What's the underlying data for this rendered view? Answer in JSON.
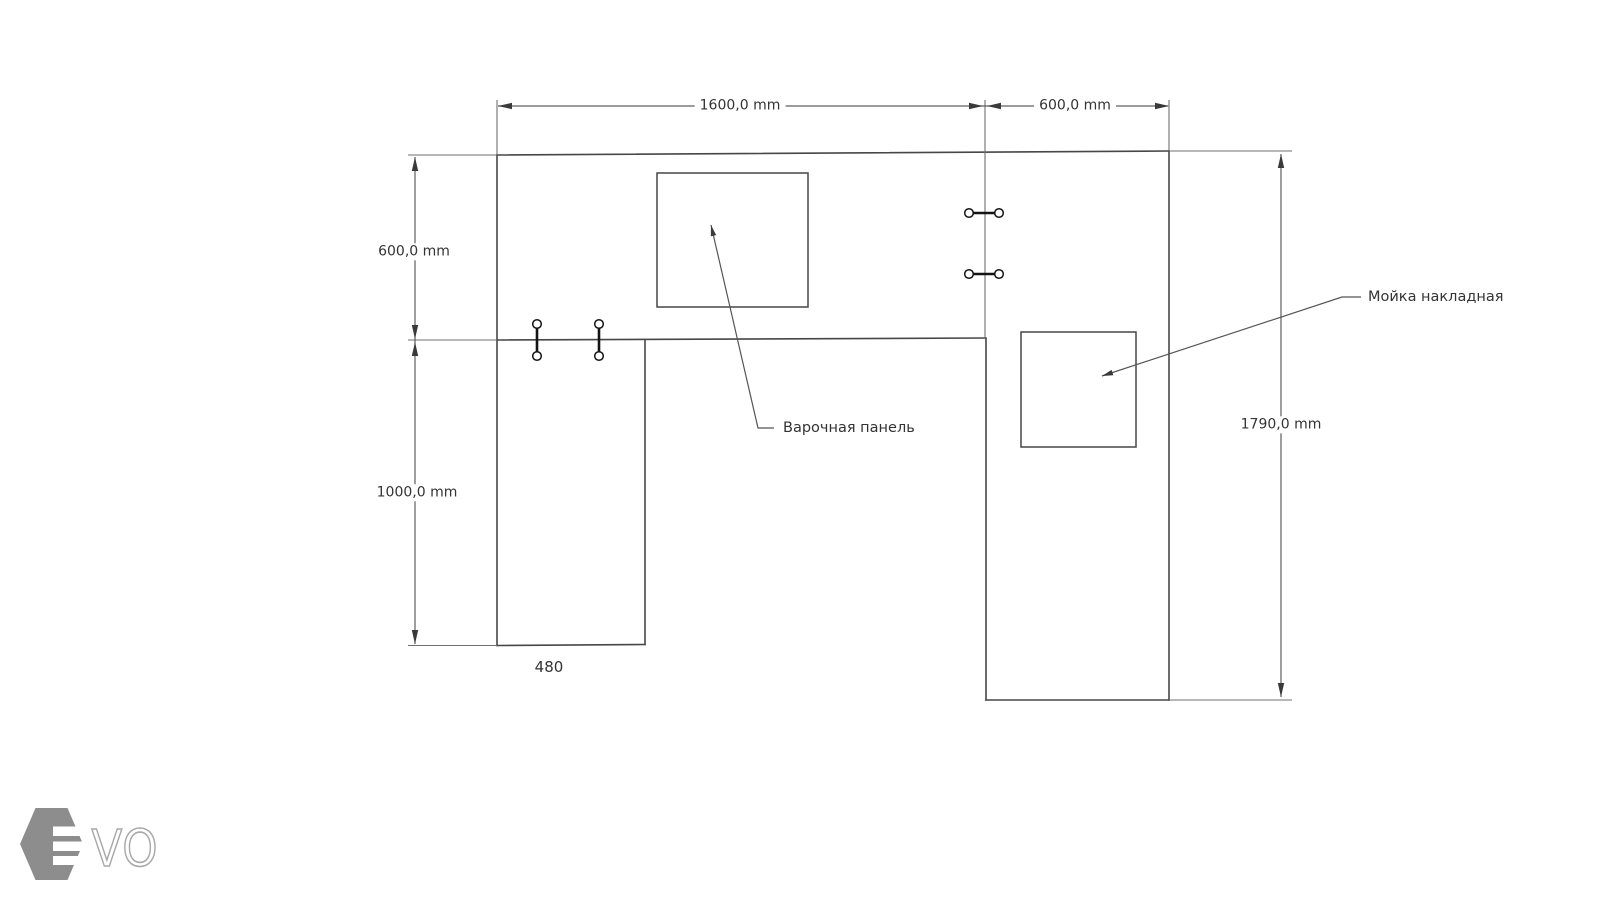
{
  "drawing": {
    "title": "countertop-plan",
    "dims": {
      "top_main": "1600,0 mm",
      "top_right": "600,0 mm",
      "left_upper": "600,0 mm",
      "left_lower": "1000,0 mm",
      "right_total": "1790,0 mm",
      "leg_width": "480"
    },
    "annotations": {
      "cooktop": "Варочная панель",
      "sink": "Мойка накладная"
    }
  },
  "logo": {
    "text": "VO"
  },
  "colors": {
    "background": "#ffffff",
    "outline": "#474747",
    "dimension": "#5f5f5f",
    "arrow": "#3a3a3a",
    "text": "#333333",
    "fastener": "#141414",
    "logo_hex": "#8d8d8d",
    "logo_letters": "#a8a8a8"
  }
}
